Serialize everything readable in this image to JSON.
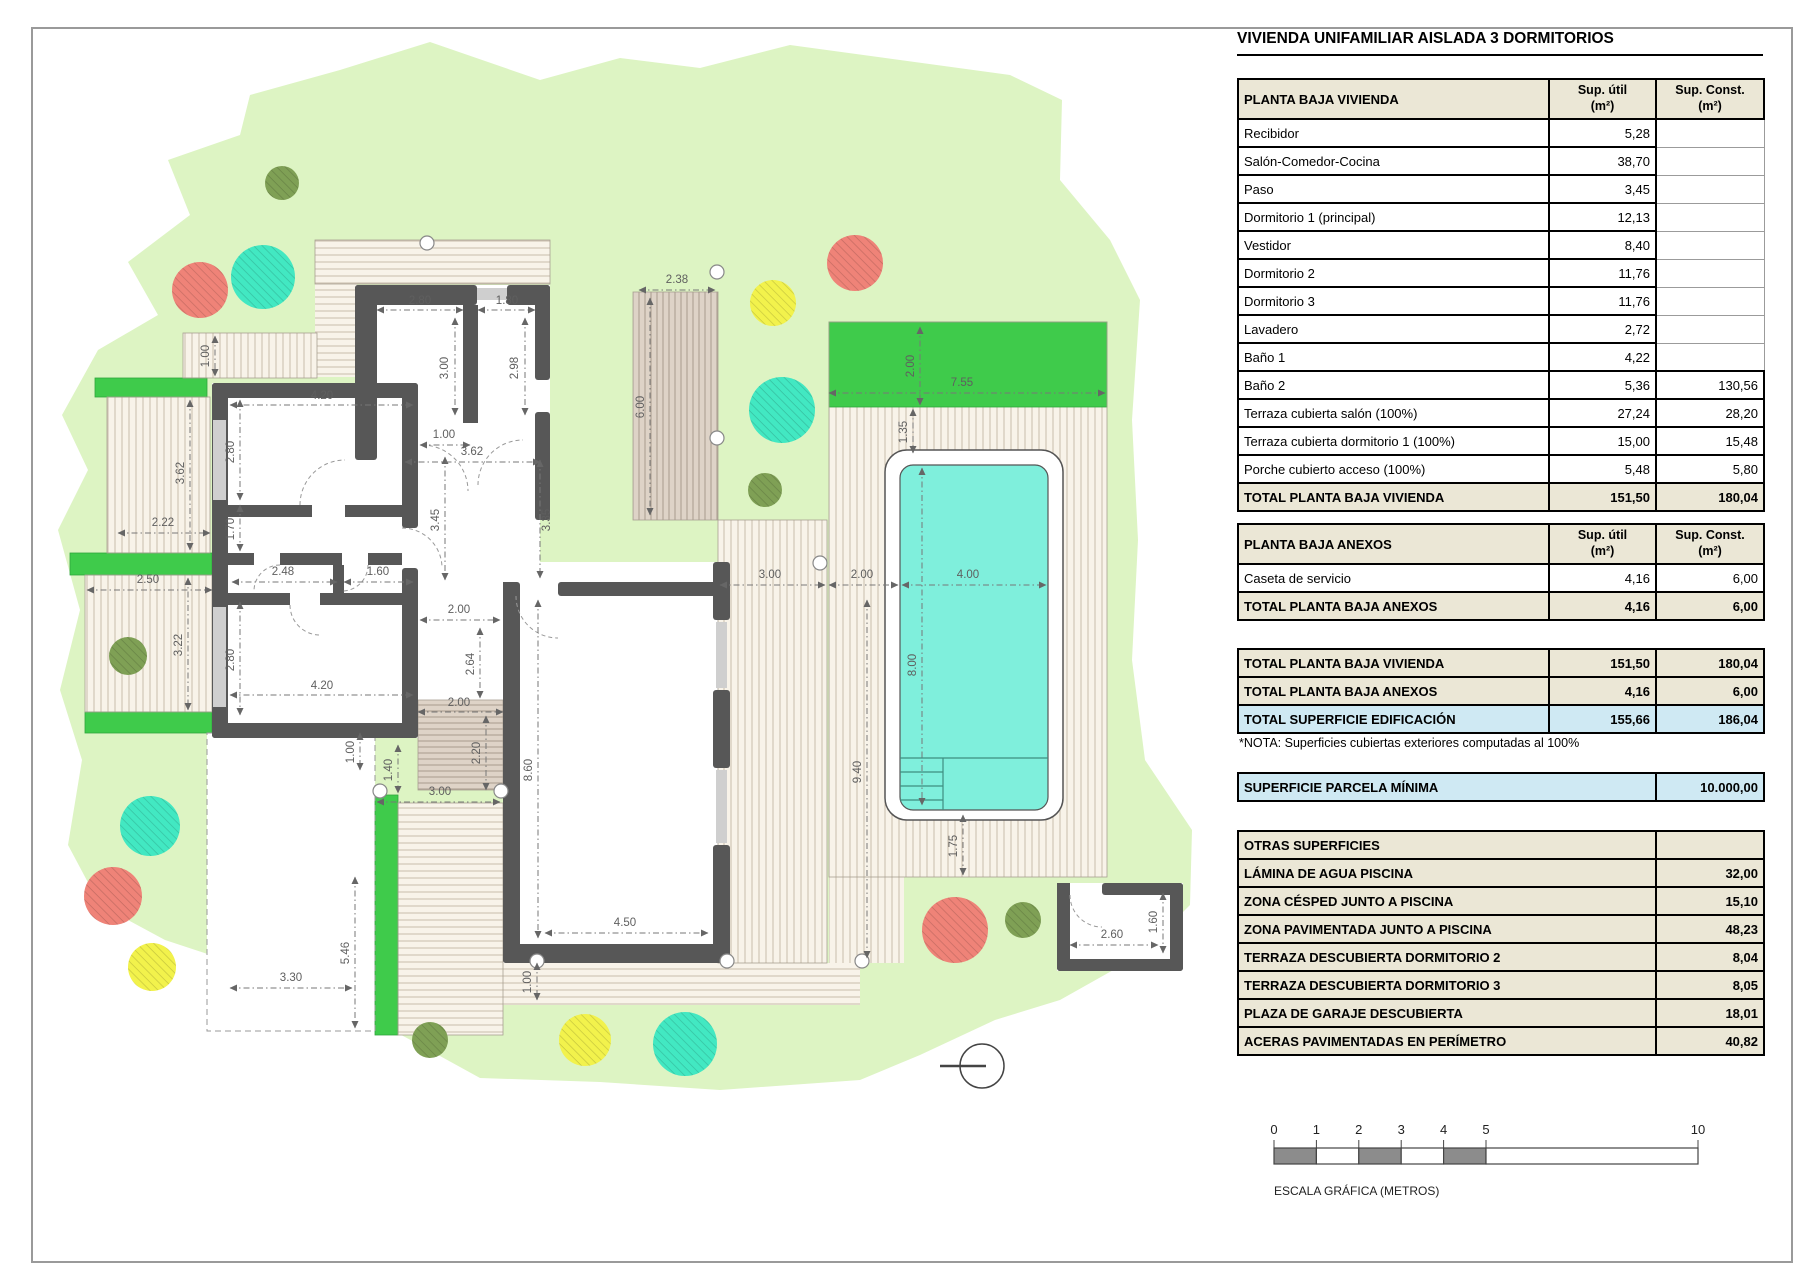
{
  "title": "VIVIENDA UNIFAMILIAR AISLADA 3 DORMITORIOS",
  "colors": {
    "lawn": "#ddf4c3",
    "bright_green": "#3fcb4b",
    "pool_water": "#7fefdc",
    "wall_gray": "#575757",
    "table_beige": "#ebe7d6",
    "highlight_blue": "#cfe9f3"
  },
  "tables": {
    "col1": "Sup. útil\n(m²)",
    "col2": "Sup. Const.\n(m²)",
    "pbv": {
      "title": "PLANTA BAJA VIVIENDA",
      "rows": [
        [
          "Recibidor",
          "5,28",
          ""
        ],
        [
          "Salón-Comedor-Cocina",
          "38,70",
          ""
        ],
        [
          "Paso",
          "3,45",
          ""
        ],
        [
          "Dormitorio 1 (principal)",
          "12,13",
          ""
        ],
        [
          "Vestidor",
          "8,40",
          ""
        ],
        [
          "Dormitorio 2",
          "11,76",
          ""
        ],
        [
          "Dormitorio 3",
          "11,76",
          ""
        ],
        [
          "Lavadero",
          "2,72",
          ""
        ],
        [
          "Baño 1",
          "4,22",
          ""
        ],
        [
          "Baño 2",
          "5,36",
          "130,56"
        ],
        [
          "Terraza cubierta salón (100%)",
          "27,24",
          "28,20"
        ],
        [
          "Terraza cubierta dormitorio 1 (100%)",
          "15,00",
          "15,48"
        ],
        [
          "Porche cubierto acceso (100%)",
          "5,48",
          "5,80"
        ]
      ],
      "total": [
        "TOTAL PLANTA BAJA VIVIENDA",
        "151,50",
        "180,04"
      ]
    },
    "anexos": {
      "title": "PLANTA BAJA ANEXOS",
      "rows": [
        [
          "Caseta de servicio",
          "4,16",
          "6,00"
        ]
      ],
      "total": [
        "TOTAL PLANTA BAJA ANEXOS",
        "4,16",
        "6,00"
      ]
    },
    "summary": [
      [
        "TOTAL PLANTA BAJA VIVIENDA",
        "151,50",
        "180,04",
        "beige"
      ],
      [
        "TOTAL PLANTA BAJA ANEXOS",
        "4,16",
        "6,00",
        "beige"
      ],
      [
        "TOTAL SUPERFICIE EDIFICACIÓN",
        "155,66",
        "186,04",
        "blue"
      ]
    ],
    "note": "*NOTA: Superficies cubiertas exteriores computadas al 100%",
    "parcela": {
      "label": "SUPERFICIE PARCELA MÍNIMA",
      "value": "10.000,00"
    },
    "otras": {
      "title": "OTRAS SUPERFICIES",
      "rows": [
        [
          "LÁMINA DE AGUA PISCINA",
          "32,00"
        ],
        [
          "ZONA CÉSPED JUNTO A PISCINA",
          "15,10"
        ],
        [
          "ZONA PAVIMENTADA JUNTO A PISCINA",
          "48,23"
        ],
        [
          "TERRAZA DESCUBIERTA DORMITORIO 2",
          "8,04"
        ],
        [
          "TERRAZA DESCUBIERTA DORMITORIO 3",
          "8,05"
        ],
        [
          "PLAZA DE GARAJE DESCUBIERTA",
          "18,01"
        ],
        [
          "ACERAS PAVIMENTADAS EN PERÍMETRO",
          "40,82"
        ]
      ]
    }
  },
  "scalebar": {
    "ticks": [
      "0",
      "1",
      "2",
      "3",
      "4",
      "5",
      "10"
    ],
    "caption": "ESCALA GRÁFICA (METROS)"
  },
  "plan": {
    "tree_colors": {
      "salmon": "#ef8378",
      "teal": "#42e8c2",
      "yellow": "#f2f24c",
      "olive": "#7fa055"
    },
    "trees": [
      [
        282,
        183,
        17,
        "olive"
      ],
      [
        200,
        290,
        28,
        "salmon"
      ],
      [
        263,
        277,
        32,
        "teal"
      ],
      [
        773,
        303,
        23,
        "yellow"
      ],
      [
        855,
        263,
        28,
        "salmon"
      ],
      [
        782,
        410,
        33,
        "teal"
      ],
      [
        765,
        490,
        17,
        "olive"
      ],
      [
        128,
        656,
        19,
        "olive"
      ],
      [
        150,
        826,
        30,
        "teal"
      ],
      [
        113,
        896,
        29,
        "salmon"
      ],
      [
        152,
        967,
        24,
        "yellow"
      ],
      [
        430,
        1040,
        18,
        "olive"
      ],
      [
        585,
        1040,
        26,
        "yellow"
      ],
      [
        685,
        1044,
        32,
        "teal"
      ],
      [
        955,
        930,
        33,
        "salmon"
      ],
      [
        1023,
        920,
        18,
        "olive"
      ]
    ],
    "greens": [
      [
        95,
        378,
        112,
        19
      ],
      [
        70,
        553,
        142,
        22
      ],
      [
        85,
        712,
        127,
        21
      ],
      [
        375,
        795,
        23,
        240
      ],
      [
        829,
        322,
        278,
        85
      ]
    ],
    "decks": [
      [
        315,
        240,
        235,
        44,
        "h",
        "light"
      ],
      [
        315,
        284,
        42,
        93,
        "h",
        "light"
      ],
      [
        183,
        333,
        134,
        45,
        "v",
        "light"
      ],
      [
        107,
        397,
        103,
        156,
        "v",
        "light"
      ],
      [
        85,
        575,
        127,
        137,
        "v",
        "light"
      ],
      [
        633,
        292,
        85,
        228,
        "v",
        "dark"
      ],
      [
        718,
        520,
        109,
        443,
        "v",
        "light"
      ],
      [
        829,
        407,
        278,
        470,
        "v",
        "light"
      ],
      [
        829,
        877,
        75,
        86,
        "v",
        "light"
      ],
      [
        398,
        803,
        105,
        232,
        "h",
        "light"
      ],
      [
        418,
        700,
        85,
        90,
        "h",
        "dark"
      ],
      [
        503,
        963,
        357,
        42,
        "h",
        "light"
      ]
    ],
    "dimensions": [
      [
        "2.80",
        377,
        310,
        463,
        310,
        420,
        304,
        0
      ],
      [
        "1.80",
        478,
        310,
        535,
        310,
        507,
        304,
        0
      ],
      [
        "3.00",
        455,
        318,
        455,
        415,
        448,
        368,
        1
      ],
      [
        "2.98",
        525,
        318,
        525,
        415,
        518,
        368,
        1
      ],
      [
        "2.38",
        639,
        290,
        715,
        290,
        677,
        283,
        0
      ],
      [
        "1.00",
        215,
        336,
        215,
        376,
        209,
        356,
        1
      ],
      [
        "4.20",
        230,
        405,
        413,
        405,
        322,
        399,
        0
      ],
      [
        "2.80",
        240,
        400,
        240,
        500,
        234,
        452,
        1
      ],
      [
        "3.62",
        190,
        400,
        190,
        550,
        184,
        473,
        1
      ],
      [
        "2.22",
        118,
        533,
        210,
        533,
        163,
        526,
        0
      ],
      [
        "2.50",
        87,
        590,
        212,
        590,
        148,
        583,
        0
      ],
      [
        "3.22",
        188,
        578,
        188,
        710,
        182,
        645,
        1
      ],
      [
        "1.70",
        240,
        505,
        240,
        551,
        234,
        529,
        1
      ],
      [
        "2.48",
        232,
        582,
        337,
        582,
        283,
        575,
        0
      ],
      [
        "1.60",
        344,
        582,
        413,
        582,
        378,
        575,
        0
      ],
      [
        "2.80",
        240,
        602,
        240,
        715,
        234,
        660,
        1
      ],
      [
        "4.20",
        230,
        695,
        413,
        695,
        322,
        689,
        0
      ],
      [
        "1.00",
        420,
        445,
        470,
        445,
        444,
        438,
        0
      ],
      [
        "3.45",
        445,
        457,
        445,
        580,
        439,
        520,
        1
      ],
      [
        "3.35",
        540,
        460,
        540,
        578,
        550,
        520,
        1
      ],
      [
        "3.62",
        405,
        462,
        540,
        462,
        472,
        455,
        0
      ],
      [
        "6.00",
        650,
        298,
        650,
        515,
        644,
        407,
        1
      ],
      [
        "2.00",
        420,
        620,
        500,
        620,
        459,
        613,
        0
      ],
      [
        "2.64",
        480,
        628,
        480,
        698,
        474,
        664,
        1
      ],
      [
        "2.00",
        418,
        712,
        503,
        712,
        459,
        706,
        0
      ],
      [
        "2.20",
        486,
        716,
        486,
        790,
        480,
        753,
        1
      ],
      [
        "1.40",
        398,
        745,
        398,
        793,
        392,
        770,
        1
      ],
      [
        "1.00",
        360,
        733,
        360,
        770,
        354,
        752,
        1
      ],
      [
        "3.00",
        377,
        802,
        500,
        802,
        440,
        795,
        0
      ],
      [
        "8.60",
        538,
        600,
        538,
        938,
        532,
        770,
        1
      ],
      [
        "4.50",
        545,
        933,
        708,
        933,
        625,
        926,
        0
      ],
      [
        "1.00",
        537,
        963,
        537,
        1000,
        531,
        982,
        1
      ],
      [
        "5.46",
        355,
        877,
        355,
        1028,
        349,
        953,
        1
      ],
      [
        "3.30",
        230,
        988,
        352,
        988,
        291,
        981,
        0
      ],
      [
        "2.00",
        920,
        327,
        920,
        405,
        914,
        366,
        1
      ],
      [
        "7.55",
        829,
        393,
        1105,
        393,
        962,
        386,
        0
      ],
      [
        "1.35",
        913,
        409,
        913,
        453,
        907,
        432,
        1
      ],
      [
        "3.00",
        720,
        585,
        825,
        585,
        770,
        578,
        0
      ],
      [
        "2.00",
        829,
        585,
        898,
        585,
        862,
        578,
        0
      ],
      [
        "4.00",
        902,
        585,
        1046,
        585,
        968,
        578,
        0
      ],
      [
        "8.00",
        922,
        468,
        922,
        805,
        916,
        665,
        1
      ],
      [
        "9.40",
        867,
        600,
        867,
        958,
        861,
        772,
        1
      ],
      [
        "1.75",
        963,
        815,
        963,
        875,
        957,
        846,
        1
      ],
      [
        "2.60",
        1070,
        945,
        1158,
        945,
        1112,
        938,
        0
      ],
      [
        "1.60",
        1163,
        893,
        1163,
        953,
        1157,
        922,
        1
      ]
    ]
  }
}
